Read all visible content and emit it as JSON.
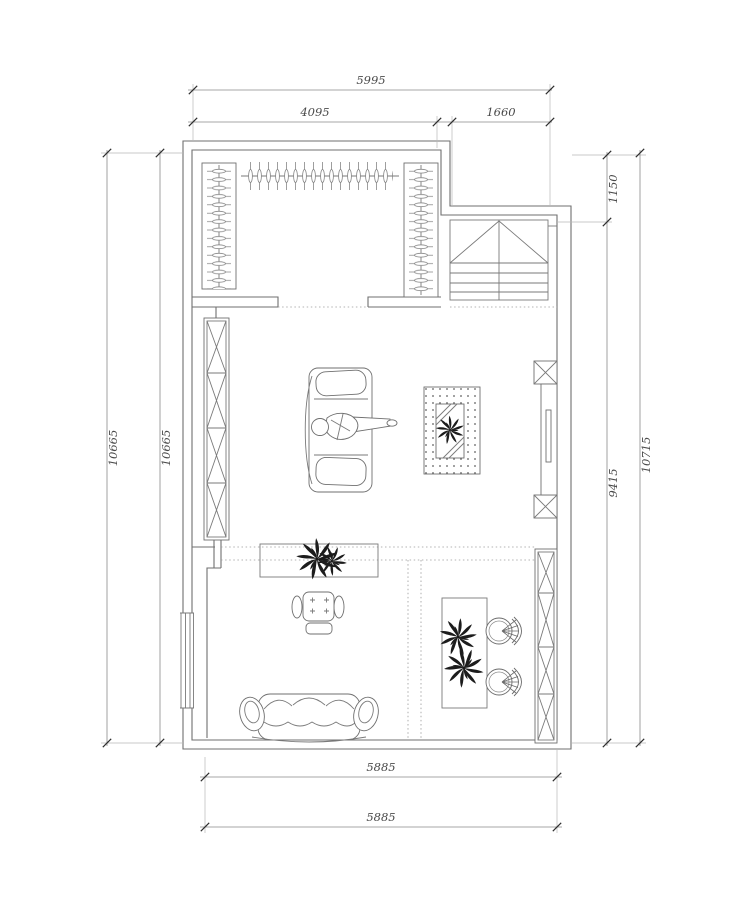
{
  "page": {
    "background": "#ffffff"
  },
  "drawing": {
    "kind": "residential floor plan (CAD line drawing)",
    "units": "mm",
    "line_color": "#6f6f6f",
    "dimension_text_color": "#4a4a4a",
    "plant_color": "#1c1c1c",
    "dimensions": {
      "top_overall": "5995",
      "top_left_segment": "4095",
      "top_right_segment": "1660",
      "left_outer": "10665",
      "left_inner": "10665",
      "right_upper_segment": "1150",
      "right_lower_segment": "9415",
      "right_outer": "10715",
      "bottom_inner": "5885",
      "bottom_outer": "5885"
    },
    "rooms": [
      {
        "name": "walk-in-closet",
        "features": [
          "hanger-rail-left",
          "hanger-rail-top",
          "hanger-rail-right"
        ]
      },
      {
        "name": "stair-hall",
        "features": [
          "staircase"
        ]
      },
      {
        "name": "lounge-area",
        "features": [
          "shelf-cabinet-left",
          "chaise-lounge-with-person",
          "coffee-table-on-dotted-rug",
          "potted-plant",
          "tv-cabinet-right"
        ]
      },
      {
        "name": "sitting-area",
        "features": [
          "console-table-with-plant",
          "tufted-armchair-with-ottoman",
          "three-seat-sofa",
          "window-left-wall"
        ]
      },
      {
        "name": "tea-area",
        "features": [
          "long-table-with-plants",
          "fan-back-chair",
          "fan-back-chair",
          "storage-cabinet-right"
        ]
      }
    ]
  }
}
